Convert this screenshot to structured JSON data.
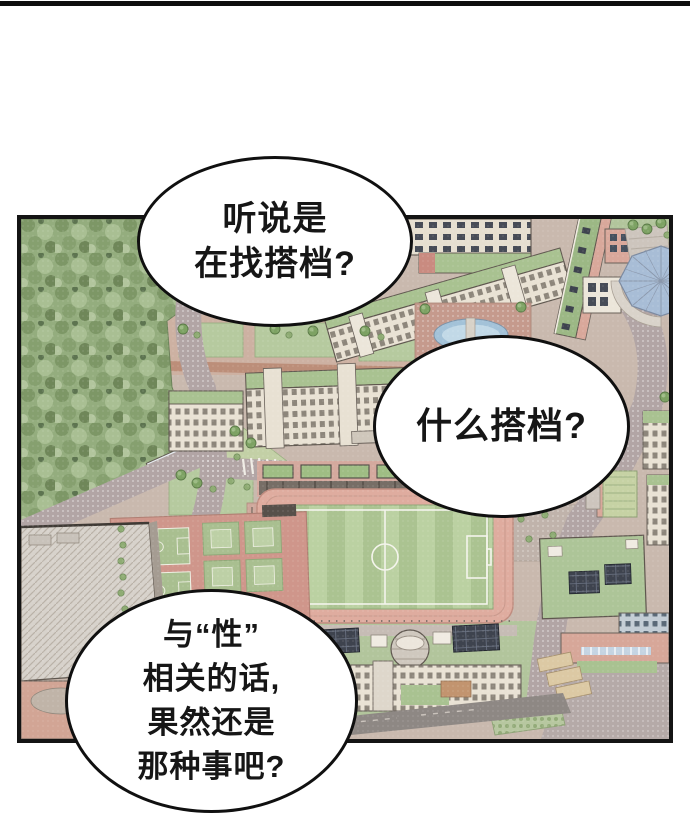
{
  "page": {
    "background_color": "#ffffff",
    "top_divider_color": "#0e0e0e"
  },
  "panel": {
    "type": "comic-panel",
    "scene": "isometric aerial view of a school campus with forest, roads, soccer field with running track, basketball courts, gymnasium, dome hall and school buildings",
    "border_color": "#141414"
  },
  "speech_bubbles": [
    {
      "lines": [
        "听说是",
        "在找搭档?"
      ]
    },
    {
      "lines": [
        "什么搭档?"
      ]
    },
    {
      "lines": [
        "与“性”",
        "相关的话,",
        "果然还是",
        "那种事吧?"
      ]
    }
  ],
  "palette": {
    "forest_green": "#94ad7e",
    "lawn_green": "#b6ca9f",
    "roof_green": "#a9c291",
    "field_green_light": "#bbd1a2",
    "field_green_dark": "#abc391",
    "track_pink": "#dfac9f",
    "court_salmon": "#cf968b",
    "road_gray": "#b2a5a5",
    "building_cream": "#e9e2d4",
    "building_pink": "#d9a89b",
    "solar_dark": "#3e434e",
    "dome_blue": "#a8bdd6",
    "pond_blue": "#a3c2d8"
  }
}
